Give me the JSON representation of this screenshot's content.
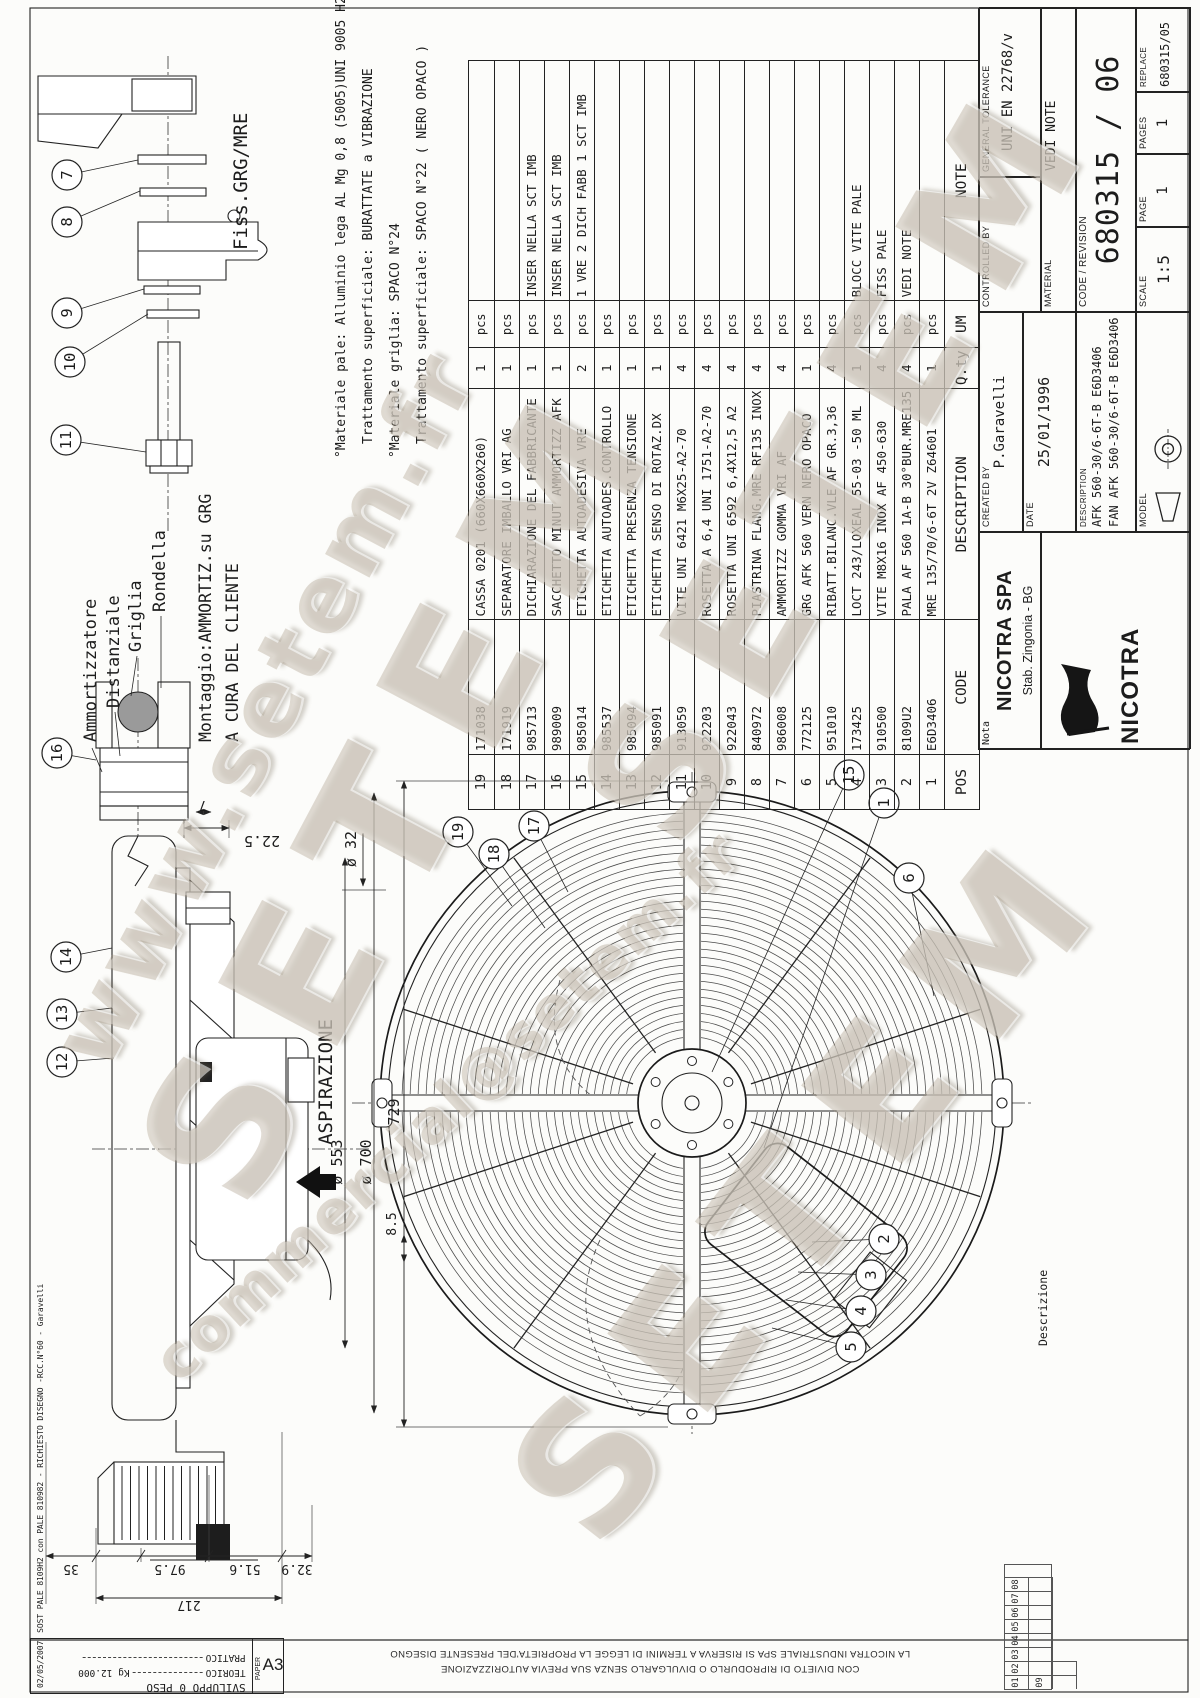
{
  "watermark": {
    "name": "SETEM",
    "url": "www.setem.fr",
    "email": "commercial@setem.fr"
  },
  "legal": {
    "restriction": "CON DIVIETO DI RIPRODURLO O DIVULGARLO SENZA SUA PREVIA AUTORIZZAZIONE",
    "ownership": "LA NICOTRA INDUSTRIALE SPA SI RISERVA A TERMINI DI LEGGE LA PROPRIETA'DEL PRESENTE DISEGNO"
  },
  "corner_block": {
    "title": "SVILUPPO 0 PESO",
    "teorico_label": "TEORICO",
    "teorico_value": "Kg 12.000",
    "pratico_label": "PRATICO",
    "paper_label": "PAPER",
    "paper_size": "A3"
  },
  "rev_note": {
    "date": "02/05/2007",
    "text": "SOST PALE 8109H2 con PALE 810982 - RICHIESTO DISEGNO -RCC.N°60 - Garavelli"
  },
  "rev_index": {
    "label": "Descrizione",
    "items": [
      "01",
      "02",
      "03",
      "04",
      "05",
      "06",
      "07",
      "08",
      "09"
    ]
  },
  "material_notes": {
    "line1": "°Materiale pale: Alluminio lega AL Mg 0,8 (5005)UNI 9005 H24",
    "line2": "Trattamento superficiale: BURATTATE a VIBRAZIONE",
    "line3": "°Materiale griglia: SPACO N°24",
    "line4": "Trattamento superficiale: SPACO N°22 ( NERO OPACO )"
  },
  "labels": {
    "fiss": "Fiss.GRG/MRE",
    "rondella": "Rondella",
    "griglia": "Griglia",
    "distanziale": "Distanziale",
    "ammortizzatore": "Ammortizzatore",
    "montaggio_line1": "Montaggio:AMMORTIZ.su GRG",
    "montaggio_line2": "A CURA DEL CLIENTE",
    "aspirazione": "ASPIRAZIONE"
  },
  "dims": {
    "d22_5": "22.5",
    "d7": "7",
    "d32": "ø 32",
    "d553": "ø 553",
    "d700": "ø 700",
    "d729": "729",
    "d8_5": "8.5",
    "d35": "35",
    "d97_5": "97.5",
    "d51_6": "51.6",
    "d217": "217",
    "d32_9": "32.9"
  },
  "callouts": {
    "n1": "1",
    "n2": "2",
    "n3": "3",
    "n4": "4",
    "n5": "5",
    "n6": "6",
    "n7": "7",
    "n8": "8",
    "n9": "9",
    "n10": "10",
    "n11": "11",
    "n12": "12",
    "n13": "13",
    "n14": "14",
    "n15": "15",
    "n16": "16",
    "n17": "17",
    "n18": "18",
    "n19": "19"
  },
  "bom": {
    "headers": {
      "pos": "POS",
      "code": "CODE",
      "description": "DESCRIPTION",
      "qty": "Q.ty",
      "um": "UM",
      "note": "NOTE"
    },
    "rows": [
      {
        "pos": "19",
        "code": "171038",
        "description": "CASSA 0201 (660X660X260)",
        "qty": "1",
        "um": "pcs",
        "note": ""
      },
      {
        "pos": "18",
        "code": "171919",
        "description": "SEPARATORE IMBALLO VRI AG",
        "qty": "1",
        "um": "pcs",
        "note": ""
      },
      {
        "pos": "17",
        "code": "985713",
        "description": "DICHIARAZIONE DEL FABBRICANTE",
        "qty": "1",
        "um": "pcs",
        "note": "INSER NELLA SCT IMB"
      },
      {
        "pos": "16",
        "code": "989009",
        "description": "SACCHETTO MINUT AMMORTIZZ AFK",
        "qty": "1",
        "um": "pcs",
        "note": "INSER NELLA SCT IMB"
      },
      {
        "pos": "15",
        "code": "985014",
        "description": "ETICHETTA AUTOADESIVA VRE",
        "qty": "2",
        "um": "pcs",
        "note": "1 VRE 2 DICH FABB 1 SCT IMB"
      },
      {
        "pos": "14",
        "code": "985537",
        "description": "ETICHETTA AUTOADES.CONTROLLO",
        "qty": "1",
        "um": "pcs",
        "note": ""
      },
      {
        "pos": "13",
        "code": "985094",
        "description": "ETICHETTA PRESENZA TENSIONE",
        "qty": "1",
        "um": "pcs",
        "note": ""
      },
      {
        "pos": "12",
        "code": "985091",
        "description": "ETICHETTA SENSO DI ROTAZ.DX",
        "qty": "1",
        "um": "pcs",
        "note": ""
      },
      {
        "pos": "11",
        "code": "913059",
        "description": "VITE UNI 6421 M6X25-A2-70",
        "qty": "4",
        "um": "pcs",
        "note": ""
      },
      {
        "pos": "10",
        "code": "922203",
        "description": "ROSETTA A 6,4 UNI 1751-A2-70",
        "qty": "4",
        "um": "pcs",
        "note": ""
      },
      {
        "pos": "9",
        "code": "922043",
        "description": "ROSETTA UNI 6592 6,4X12,5 A2",
        "qty": "4",
        "um": "pcs",
        "note": ""
      },
      {
        "pos": "8",
        "code": "840972",
        "description": "PIASTRINA FLANG.MRE RF135 INOX",
        "qty": "4",
        "um": "pcs",
        "note": ""
      },
      {
        "pos": "7",
        "code": "986008",
        "description": "AMMORTIZZ GOMMA VRI AF",
        "qty": "4",
        "um": "pcs",
        "note": ""
      },
      {
        "pos": "6",
        "code": "772125",
        "description": "GRG AFK 560 VERN NERO OPACO",
        "qty": "1",
        "um": "pcs",
        "note": ""
      },
      {
        "pos": "5",
        "code": "951010",
        "description": "RIBATT.BILANC.VLE AF GR.3,36",
        "qty": "4",
        "um": "pcs",
        "note": ""
      },
      {
        "pos": "4",
        "code": "173425",
        "description": "LOCT 243/LOXEAL 55-03 -50 ML",
        "qty": "1",
        "um": "pcs",
        "note": "BLOCC VITE PALE"
      },
      {
        "pos": "3",
        "code": "910500",
        "description": "VITE M8X16 INOX AF 450-630",
        "qty": "4",
        "um": "pcs",
        "note": "FISS PALE"
      },
      {
        "pos": "2",
        "code": "8109U2",
        "description": "PALA AF 560 1A-B 30°BUR.MRE135",
        "qty": "4",
        "um": "pcs",
        "note": "VEDI NOTE"
      },
      {
        "pos": "1",
        "code": "E6D3406",
        "description": "MRE 135/70/6-6T 2V Z64601",
        "qty": "1",
        "um": "pcs",
        "note": ""
      }
    ]
  },
  "title_block": {
    "nota_label": "Nota",
    "company": "NICOTRA SPA",
    "plant": "Stab. Zingonia - BG",
    "logo_text": "NICOTRA",
    "created_by_label": "CREATED BY",
    "created_by": "P.Garavelli",
    "date_label": "DATE",
    "date": "25/01/1996",
    "description_label": "DESCRIPTION",
    "desc_line1": "AFK 560-30/6-6T-B E6D3406",
    "desc_line2": "FAN AFK 560-30/6-6T-B E6D3406",
    "model_label": "MODEL",
    "controlled_by_label": "CONTROLLED BY",
    "tolerance_label": "GENERAL TOLERANCE",
    "tolerance": "UNI EN 22768/v",
    "material_label": "MATERIAL",
    "material": "VEDI NOTE",
    "code_revision_label": "CODE / REVISION",
    "code_revision": "680315 / 06",
    "scale_label": "SCALE",
    "scale": "1:5",
    "page_label": "PAGE",
    "page": "1",
    "pages_label": "PAGES",
    "pages": "1",
    "replace_label": "REPLACE",
    "replace": "680315/05"
  }
}
